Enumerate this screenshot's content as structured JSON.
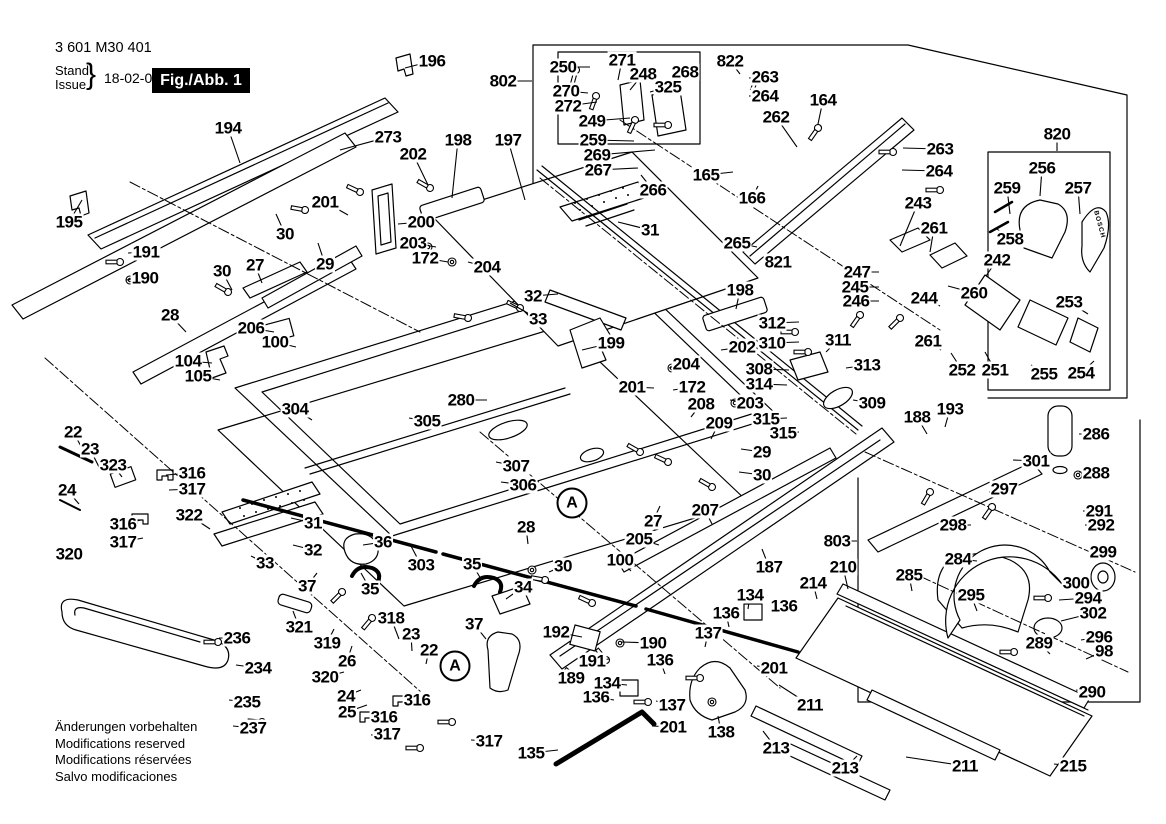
{
  "document": {
    "part_number": "3 601 M30 401",
    "stand_label": "Stand",
    "issue_label": "Issue",
    "brace": "}",
    "date": "18-02-09",
    "figure_label": "Fig./Abb. 1",
    "revision_notes": [
      "Änderungen vorbehalten",
      "Modifications reserved",
      "Modifications réservées",
      "Salvo modificaciones"
    ]
  },
  "colors": {
    "ink": "#000000",
    "paper": "#ffffff"
  },
  "diagram": {
    "type": "exploded-view-parts-diagram",
    "subject": "table saw parts figure 1",
    "brand_marking": "BOSCH",
    "detail_markers": [
      {
        "label": "A",
        "x": 455,
        "y": 666
      },
      {
        "label": "A",
        "x": 572,
        "y": 503
      }
    ],
    "callouts": [
      [
        "194",
        228,
        128,
        240,
        163
      ],
      [
        "195",
        69,
        222,
        82,
        200
      ],
      [
        "191",
        146,
        252,
        128,
        253
      ],
      [
        "190",
        145,
        278,
        126,
        280
      ],
      [
        "196",
        432,
        61,
        405,
        68
      ],
      [
        "273",
        388,
        137,
        340,
        150
      ],
      [
        "202",
        413,
        154,
        428,
        185
      ],
      [
        "198",
        458,
        140,
        452,
        198
      ],
      [
        "197",
        508,
        140,
        525,
        200
      ],
      [
        "201",
        325,
        202,
        348,
        215
      ],
      [
        "30",
        285,
        234,
        276,
        214
      ],
      [
        "29",
        325,
        264,
        318,
        243
      ],
      [
        "27",
        255,
        265,
        262,
        283
      ],
      [
        "30",
        222,
        271,
        232,
        290
      ],
      [
        "28",
        170,
        315,
        186,
        332
      ],
      [
        "206",
        251,
        328,
        274,
        332
      ],
      [
        "100",
        275,
        342,
        296,
        347
      ],
      [
        "104",
        188,
        361,
        212,
        363
      ],
      [
        "105",
        198,
        376,
        220,
        380
      ],
      [
        "200",
        421,
        222,
        398,
        224
      ],
      [
        "203",
        413,
        243,
        436,
        247
      ],
      [
        "172",
        425,
        258,
        448,
        262
      ],
      [
        "204",
        487,
        267,
        468,
        262
      ],
      [
        "802",
        503,
        81,
        532,
        81
      ],
      [
        "250",
        563,
        67,
        590,
        67
      ],
      [
        "271",
        622,
        60,
        618,
        80
      ],
      [
        "248",
        643,
        74,
        630,
        90
      ],
      [
        "268",
        685,
        72,
        676,
        95
      ],
      [
        "325",
        668,
        87,
        650,
        92
      ],
      [
        "270",
        566,
        91,
        588,
        93
      ],
      [
        "272",
        568,
        106,
        597,
        102
      ],
      [
        "249",
        592,
        121,
        630,
        118
      ],
      [
        "259",
        593,
        140,
        634,
        141
      ],
      [
        "269",
        597,
        155,
        655,
        150
      ],
      [
        "267",
        598,
        170,
        638,
        168
      ],
      [
        "266",
        653,
        190,
        641,
        175
      ],
      [
        "165",
        706,
        175,
        733,
        172
      ],
      [
        "166",
        752,
        198,
        758,
        186
      ],
      [
        "822",
        730,
        61,
        740,
        74
      ],
      [
        "263",
        765,
        77,
        749,
        78
      ],
      [
        "264",
        765,
        96,
        749,
        96
      ],
      [
        "164",
        823,
        100,
        818,
        124
      ],
      [
        "262",
        776,
        117,
        797,
        147
      ],
      [
        "820",
        1057,
        134,
        1057,
        151
      ],
      [
        "263",
        940,
        149,
        903,
        148
      ],
      [
        "264",
        939,
        171,
        902,
        170
      ],
      [
        "256",
        1042,
        168,
        1040,
        196
      ],
      [
        "257",
        1078,
        188,
        1080,
        214
      ],
      [
        "259",
        1007,
        188,
        1010,
        214
      ],
      [
        "258",
        1010,
        239,
        997,
        229
      ],
      [
        "243",
        918,
        203,
        900,
        246
      ],
      [
        "261",
        934,
        228,
        930,
        252
      ],
      [
        "242",
        997,
        260,
        986,
        276
      ],
      [
        "247",
        857,
        272,
        879,
        272
      ],
      [
        "245",
        855,
        287,
        879,
        287
      ],
      [
        "246",
        856,
        301,
        879,
        301
      ],
      [
        "244",
        924,
        298,
        940,
        306
      ],
      [
        "260",
        974,
        293,
        948,
        286
      ],
      [
        "253",
        1069,
        302,
        1088,
        314
      ],
      [
        "261",
        928,
        341,
        941,
        350
      ],
      [
        "252",
        962,
        370,
        951,
        353
      ],
      [
        "251",
        995,
        370,
        985,
        352
      ],
      [
        "255",
        1044,
        374,
        1031,
        365
      ],
      [
        "254",
        1081,
        373,
        1094,
        361
      ],
      [
        "265",
        737,
        243,
        757,
        247
      ],
      [
        "821",
        778,
        262,
        764,
        263
      ],
      [
        "31",
        650,
        230,
        618,
        222
      ],
      [
        "32",
        533,
        296,
        558,
        294
      ],
      [
        "33",
        538,
        319,
        510,
        303
      ],
      [
        "199",
        611,
        343,
        582,
        350
      ],
      [
        "198",
        740,
        290,
        736,
        309
      ],
      [
        "202",
        742,
        347,
        721,
        350
      ],
      [
        "204",
        686,
        364,
        669,
        368
      ],
      [
        "201",
        632,
        387,
        654,
        388
      ],
      [
        "172",
        692,
        387,
        673,
        390
      ],
      [
        "203",
        750,
        403,
        730,
        400
      ],
      [
        "208",
        701,
        404,
        691,
        417
      ],
      [
        "209",
        719,
        423,
        711,
        439
      ],
      [
        "312",
        772,
        323,
        799,
        322
      ],
      [
        "310",
        772,
        343,
        799,
        342
      ],
      [
        "311",
        838,
        340,
        826,
        352
      ],
      [
        "313",
        867,
        365,
        846,
        368
      ],
      [
        "308",
        759,
        369,
        789,
        370
      ],
      [
        "314",
        759,
        384,
        787,
        385
      ],
      [
        "315",
        766,
        419,
        787,
        418
      ],
      [
        "315",
        783,
        433,
        799,
        432
      ],
      [
        "309",
        872,
        403,
        853,
        400
      ],
      [
        "188",
        917,
        417,
        927,
        434
      ],
      [
        "193",
        950,
        409,
        945,
        427
      ],
      [
        "304",
        295,
        409,
        312,
        420
      ],
      [
        "305",
        427,
        421,
        409,
        418
      ],
      [
        "280",
        461,
        400,
        487,
        400
      ],
      [
        "307",
        516,
        466,
        496,
        462
      ],
      [
        "306",
        523,
        485,
        501,
        482
      ],
      [
        "22",
        73,
        432,
        86,
        455
      ],
      [
        "23",
        90,
        449,
        99,
        467
      ],
      [
        "323",
        113,
        465,
        122,
        477
      ],
      [
        "316",
        192,
        473,
        166,
        475
      ],
      [
        "317",
        192,
        489,
        169,
        490
      ],
      [
        "24",
        67,
        490,
        79,
        504
      ],
      [
        "316",
        123,
        524,
        141,
        520
      ],
      [
        "317",
        123,
        542,
        143,
        538
      ],
      [
        "320",
        69,
        554,
        83,
        546
      ],
      [
        "322",
        189,
        515,
        210,
        529
      ],
      [
        "31",
        313,
        523,
        291,
        518
      ],
      [
        "32",
        313,
        550,
        293,
        545
      ],
      [
        "33",
        265,
        563,
        251,
        556
      ],
      [
        "36",
        383,
        542,
        363,
        545
      ],
      [
        "35",
        370,
        589,
        361,
        573
      ],
      [
        "303",
        421,
        565,
        411,
        546
      ],
      [
        "35",
        472,
        564,
        481,
        579
      ],
      [
        "34",
        523,
        587,
        506,
        599
      ],
      [
        "37",
        307,
        586,
        317,
        573
      ],
      [
        "37",
        474,
        624,
        486,
        639
      ],
      [
        "318",
        391,
        618,
        399,
        639
      ],
      [
        "321",
        299,
        627,
        293,
        611
      ],
      [
        "319",
        327,
        643,
        334,
        629
      ],
      [
        "26",
        347,
        661,
        352,
        646
      ],
      [
        "23",
        411,
        634,
        412,
        651
      ],
      [
        "22",
        429,
        650,
        426,
        664
      ],
      [
        "320",
        325,
        677,
        344,
        672
      ],
      [
        "24",
        346,
        696,
        361,
        690
      ],
      [
        "25",
        347,
        712,
        367,
        705
      ],
      [
        "316",
        417,
        700,
        401,
        702
      ],
      [
        "316",
        384,
        717,
        369,
        718
      ],
      [
        "317",
        387,
        734,
        371,
        735
      ],
      [
        "317",
        489,
        741,
        471,
        740
      ],
      [
        "236",
        237,
        638,
        219,
        638
      ],
      [
        "234",
        258,
        668,
        236,
        665
      ],
      [
        "235",
        247,
        702,
        229,
        700
      ],
      [
        "237",
        253,
        728,
        233,
        726
      ],
      [
        "135",
        531,
        753,
        558,
        750
      ],
      [
        "189",
        571,
        678,
        585,
        668
      ],
      [
        "191",
        592,
        661,
        609,
        659
      ],
      [
        "190",
        653,
        643,
        621,
        642
      ],
      [
        "192",
        556,
        632,
        582,
        637
      ],
      [
        "136",
        596,
        697,
        614,
        700
      ],
      [
        "134",
        607,
        683,
        627,
        685
      ],
      [
        "137",
        672,
        705,
        656,
        701
      ],
      [
        "201",
        673,
        727,
        652,
        726
      ],
      [
        "138",
        721,
        732,
        718,
        716
      ],
      [
        "136",
        660,
        660,
        665,
        674
      ],
      [
        "137",
        708,
        633,
        705,
        647
      ],
      [
        "136",
        726,
        613,
        729,
        627
      ],
      [
        "134",
        750,
        595,
        748,
        609
      ],
      [
        "136",
        784,
        606,
        771,
        612
      ],
      [
        "201",
        774,
        668,
        757,
        666
      ],
      [
        "211",
        810,
        705,
        779,
        685
      ],
      [
        "213",
        776,
        748,
        763,
        731
      ],
      [
        "213",
        845,
        768,
        857,
        756
      ],
      [
        "211",
        965,
        766,
        906,
        757
      ],
      [
        "215",
        1073,
        766,
        1054,
        764
      ],
      [
        "29",
        762,
        452,
        741,
        449
      ],
      [
        "30",
        762,
        475,
        739,
        472
      ],
      [
        "27",
        653,
        521,
        660,
        506
      ],
      [
        "207",
        705,
        510,
        712,
        524
      ],
      [
        "205",
        639,
        539,
        659,
        545
      ],
      [
        "100",
        620,
        560,
        631,
        571
      ],
      [
        "30",
        563,
        566,
        549,
        572
      ],
      [
        "28",
        526,
        527,
        528,
        544
      ],
      [
        "803",
        837,
        541,
        857,
        541
      ],
      [
        "187",
        769,
        567,
        762,
        549
      ],
      [
        "210",
        843,
        567,
        848,
        589
      ],
      [
        "214",
        813,
        583,
        817,
        599
      ],
      [
        "285",
        909,
        575,
        912,
        591
      ],
      [
        "295",
        971,
        595,
        977,
        611
      ],
      [
        "284",
        958,
        559,
        977,
        561
      ],
      [
        "298",
        953,
        525,
        971,
        525
      ],
      [
        "297",
        1004,
        489,
        989,
        492
      ],
      [
        "301",
        1036,
        461,
        1013,
        460
      ],
      [
        "286",
        1096,
        434,
        1079,
        434
      ],
      [
        "288",
        1096,
        473,
        1079,
        472
      ],
      [
        "291",
        1099,
        511,
        1083,
        511
      ],
      [
        "292",
        1101,
        525,
        1085,
        525
      ],
      [
        "299",
        1103,
        552,
        1089,
        556
      ],
      [
        "300",
        1076,
        583,
        1091,
        577
      ],
      [
        "294",
        1088,
        598,
        1059,
        600
      ],
      [
        "302",
        1093,
        613,
        1061,
        621
      ],
      [
        "296",
        1099,
        637,
        1081,
        640
      ],
      [
        "289",
        1039,
        643,
        1050,
        654
      ],
      [
        "98",
        1104,
        651,
        1086,
        659
      ],
      [
        "290",
        1092,
        692,
        1076,
        690
      ]
    ]
  }
}
